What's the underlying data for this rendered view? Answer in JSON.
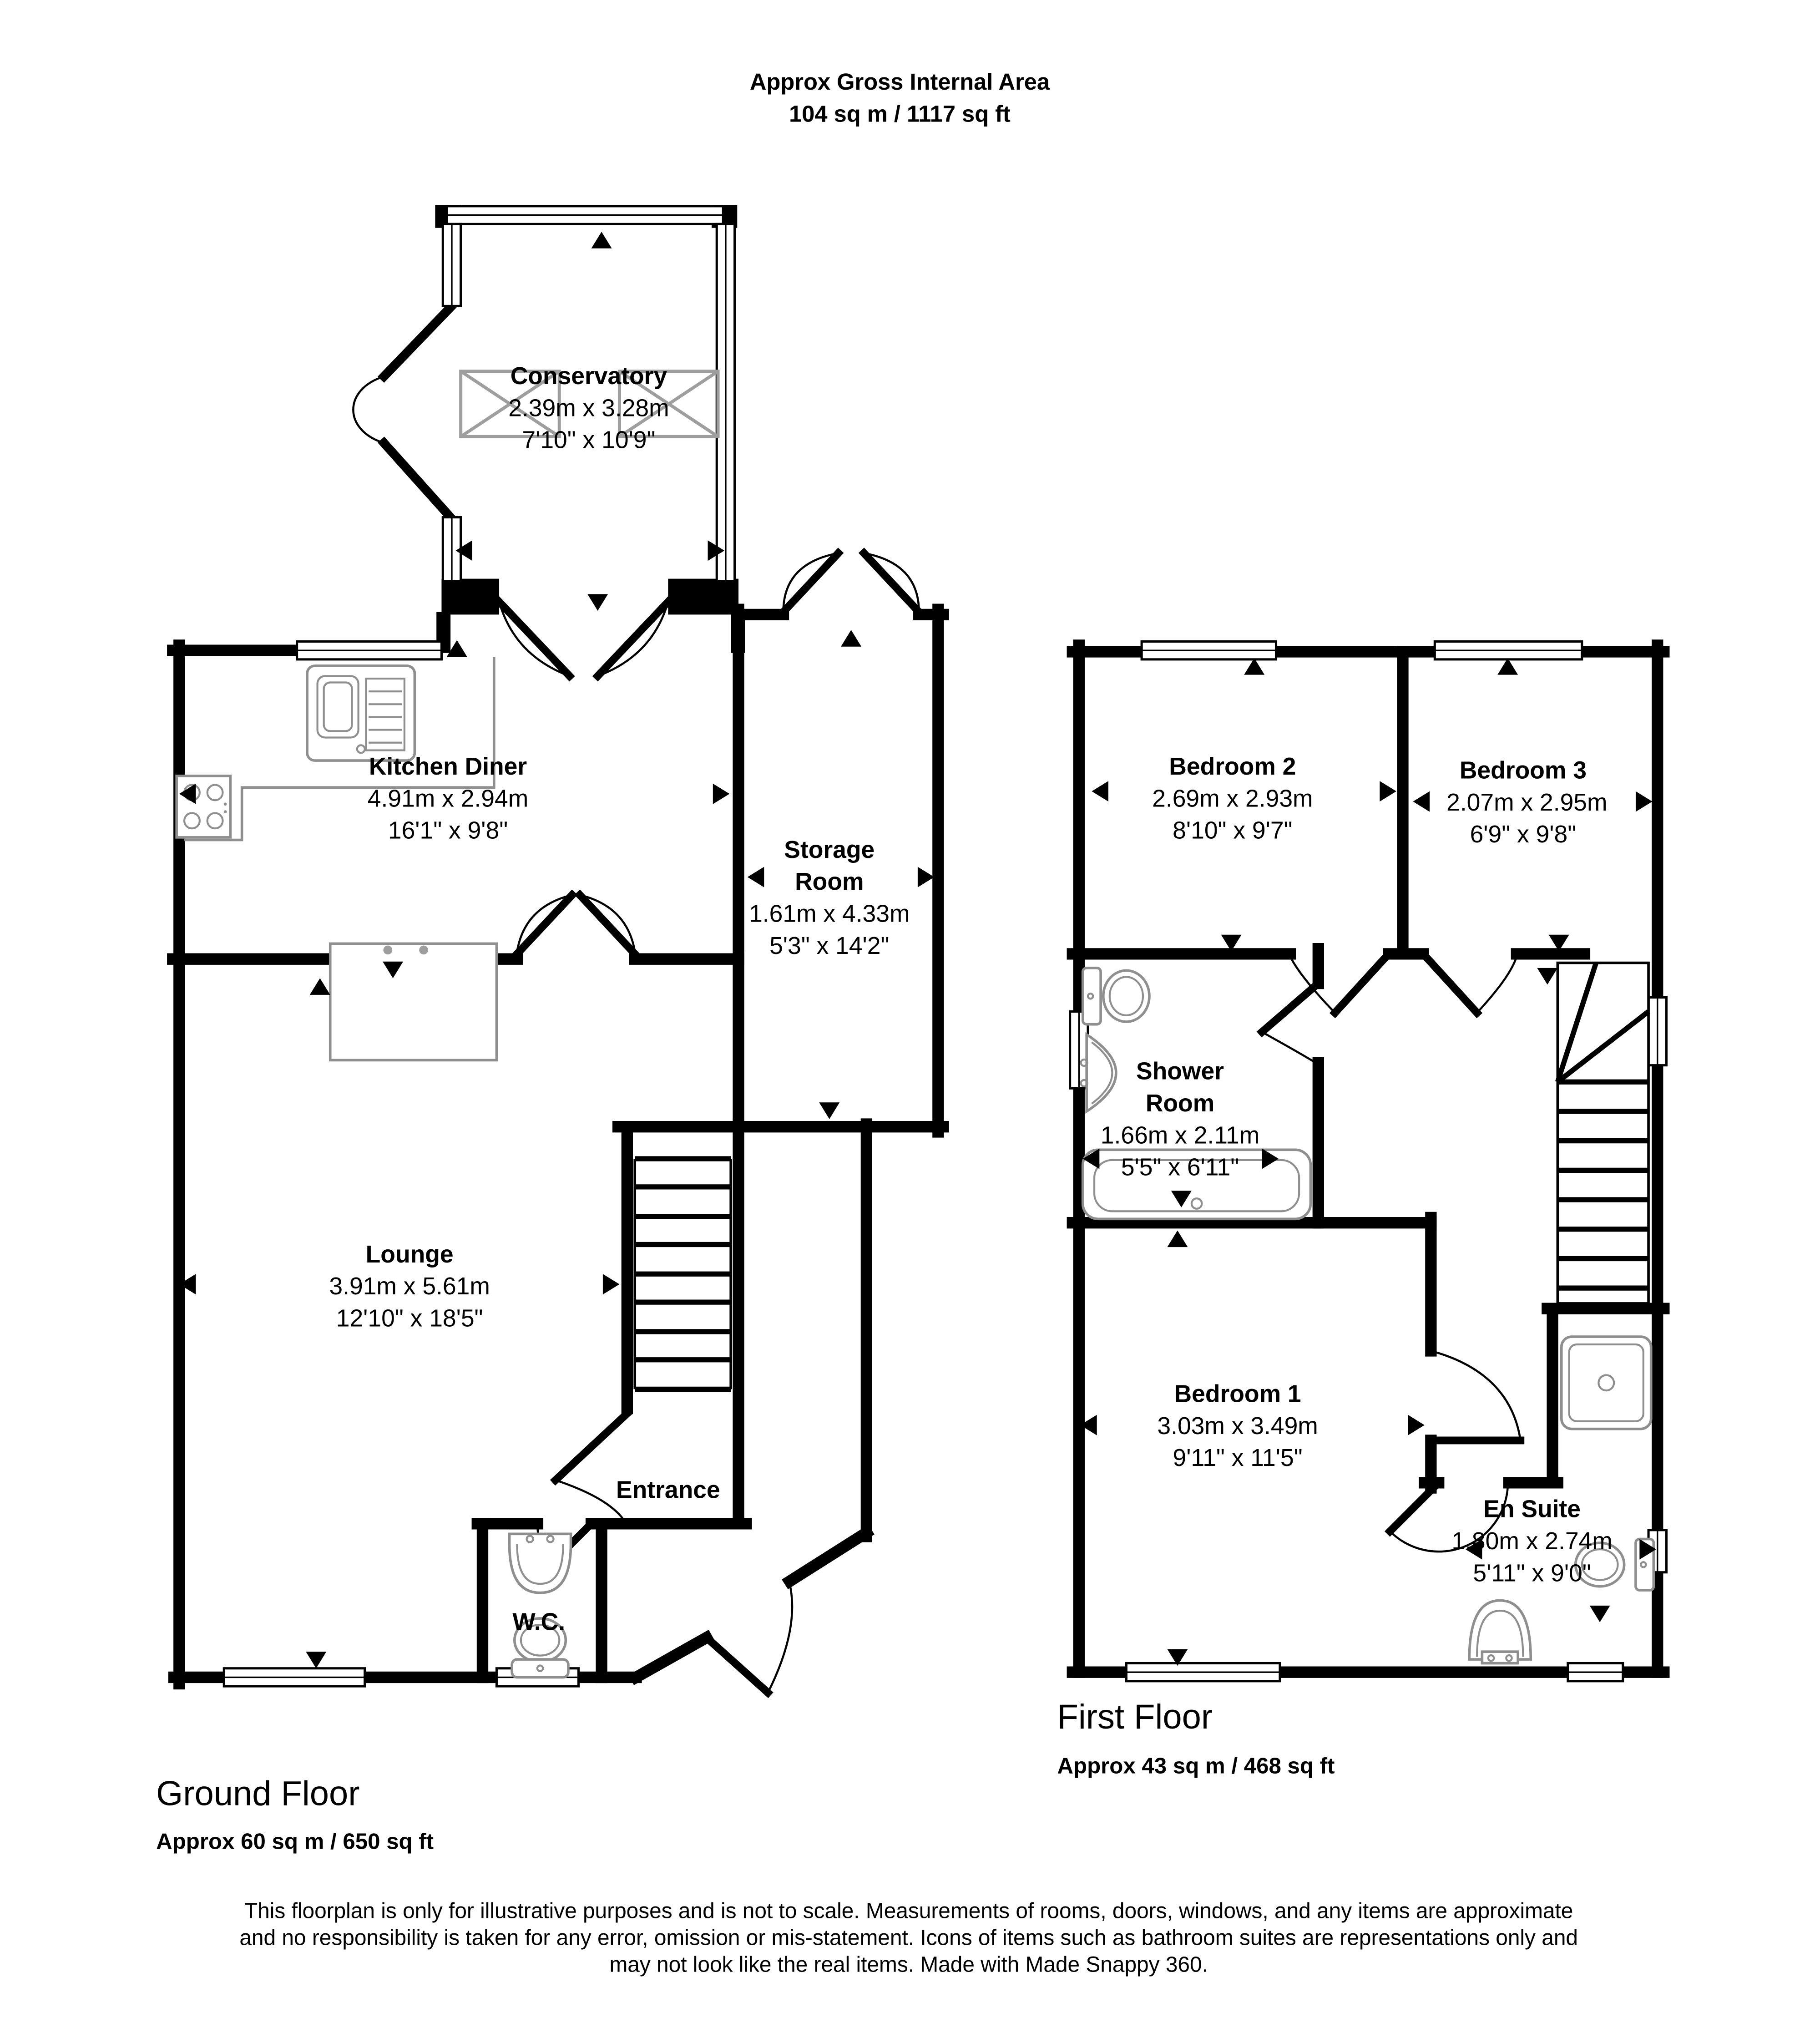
{
  "title": {
    "line1": "Approx Gross Internal Area",
    "line2": "104 sq m / 1117 sq ft"
  },
  "ground": {
    "floor_label": "Ground Floor",
    "floor_area": "Approx 60 sq m / 650 sq ft",
    "rooms": {
      "conservatory": {
        "name": "Conservatory",
        "metric": "2.39m x 3.28m",
        "imperial": "7'10\" x 10'9\""
      },
      "kitchen": {
        "name": "Kitchen Diner",
        "metric": "4.91m x 2.94m",
        "imperial": "16'1\" x 9'8\""
      },
      "storage": {
        "name_line1": "Storage",
        "name_line2": "Room",
        "metric": "1.61m x 4.33m",
        "imperial": "5'3\" x 14'2\""
      },
      "lounge": {
        "name": "Lounge",
        "metric": "3.91m x 5.61m",
        "imperial": "12'10\" x 18'5\""
      },
      "entrance": {
        "name": "Entrance"
      },
      "wc": {
        "name": "W.C."
      }
    }
  },
  "first": {
    "floor_label": "First Floor",
    "floor_area": "Approx 43 sq m / 468 sq ft",
    "rooms": {
      "bedroom2": {
        "name": "Bedroom 2",
        "metric": "2.69m x 2.93m",
        "imperial": "8'10\" x 9'7\""
      },
      "bedroom3": {
        "name": "Bedroom 3",
        "metric": "2.07m x 2.95m",
        "imperial": "6'9\" x 9'8\""
      },
      "shower": {
        "name_line1": "Shower",
        "name_line2": "Room",
        "metric": "1.66m x 2.11m",
        "imperial": "5'5\" x 6'11\""
      },
      "bedroom1": {
        "name": "Bedroom 1",
        "metric": "3.03m x 3.49m",
        "imperial": "9'11\" x 11'5\""
      },
      "ensuite": {
        "name": "En Suite",
        "metric": "1.80m x 2.74m",
        "imperial": "5'11\" x 9'0\""
      }
    }
  },
  "footer": {
    "line1": "This floorplan is only for illustrative purposes and is not to scale. Measurements of rooms, doors, windows, and any items are approximate",
    "line2": "and no responsibility is taken for any error, omission or mis-statement. Icons of items such as bathroom suites are representations only and",
    "line3": "may not look like the real items. Made with Made Snappy 360."
  },
  "colors": {
    "wall": "#000000",
    "text": "#000000",
    "fixture": "#8f8f8f",
    "skylight": "#9e9e9e",
    "background": "#ffffff"
  }
}
